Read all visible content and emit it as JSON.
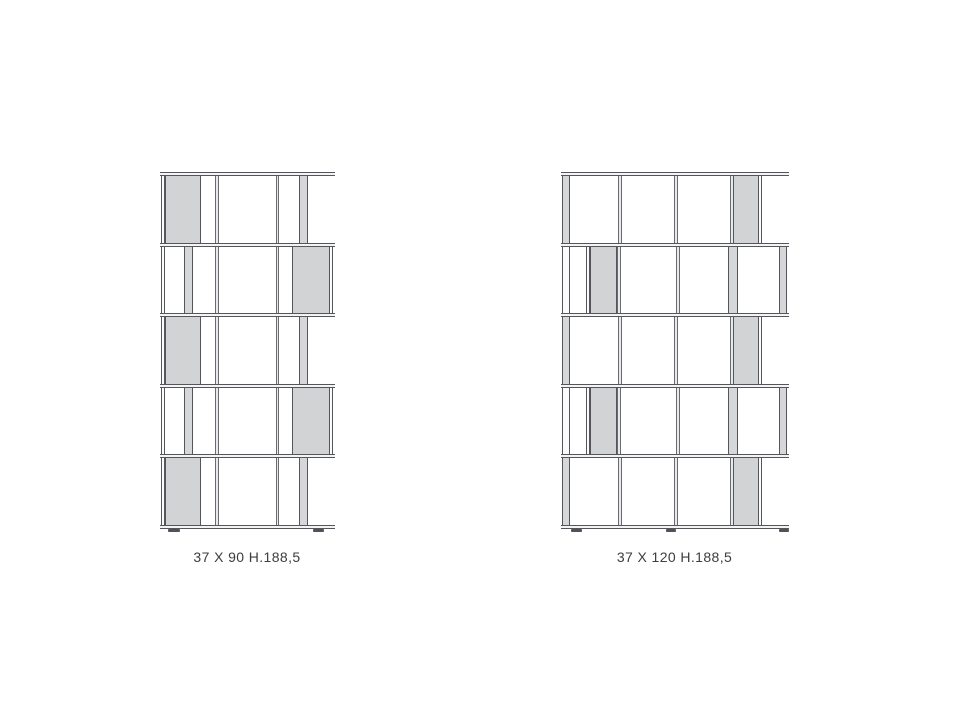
{
  "page": {
    "background": "#ffffff",
    "width": 970,
    "height": 728
  },
  "diagram": {
    "type": "furniture-dimension-drawing",
    "description": "Two staggered modular bookcase elevation drawings with size captions",
    "colors": {
      "line": "#55565b",
      "line_soft": "#6a6b70",
      "shelf_fill": "#f4f4f5",
      "panel_fill": "#d2d3d5",
      "post_fill": "#d6d7d9",
      "divider_fill": "#e8e9ea",
      "edge_fill": "#fbfbfc",
      "foot_color": "#515257",
      "label_color": "#3c3d41"
    },
    "units": [
      {
        "id": "bookcase-37x90",
        "label": "37 X 90 H.188,5",
        "origin": {
          "x": 161,
          "y": 172
        },
        "union_width": 172,
        "shelf_ys": [
          0,
          71,
          141,
          212,
          282,
          353
        ],
        "shelf_thickness": 3,
        "rows": [
          {
            "align": "left",
            "verticals": [
              {
                "x": 0,
                "w": 4,
                "t": "edge"
              },
              {
                "x": 54,
                "w": 4,
                "t": "divider"
              },
              {
                "x": 115,
                "w": 3,
                "t": "divider"
              },
              {
                "x": 138,
                "w": 9,
                "t": "post"
              }
            ],
            "panel": {
              "x": 4,
              "w": 36
            }
          },
          {
            "align": "right",
            "verticals": [
              {
                "x": 0,
                "w": 4,
                "t": "edge"
              },
              {
                "x": 23,
                "w": 9,
                "t": "post"
              },
              {
                "x": 54,
                "w": 4,
                "t": "divider"
              },
              {
                "x": 115,
                "w": 3,
                "t": "divider"
              },
              {
                "x": 168,
                "w": 4,
                "t": "edge"
              }
            ],
            "panel": {
              "x": 131,
              "w": 38
            }
          },
          {
            "align": "left",
            "verticals": [
              {
                "x": 0,
                "w": 4,
                "t": "edge"
              },
              {
                "x": 54,
                "w": 4,
                "t": "divider"
              },
              {
                "x": 115,
                "w": 3,
                "t": "divider"
              },
              {
                "x": 138,
                "w": 9,
                "t": "post"
              }
            ],
            "panel": {
              "x": 4,
              "w": 36
            }
          },
          {
            "align": "right",
            "verticals": [
              {
                "x": 0,
                "w": 4,
                "t": "edge"
              },
              {
                "x": 23,
                "w": 9,
                "t": "post"
              },
              {
                "x": 54,
                "w": 4,
                "t": "divider"
              },
              {
                "x": 115,
                "w": 3,
                "t": "divider"
              },
              {
                "x": 168,
                "w": 4,
                "t": "edge"
              }
            ],
            "panel": {
              "x": 131,
              "w": 38
            }
          },
          {
            "align": "left",
            "verticals": [
              {
                "x": 0,
                "w": 4,
                "t": "edge"
              },
              {
                "x": 54,
                "w": 4,
                "t": "divider"
              },
              {
                "x": 115,
                "w": 3,
                "t": "divider"
              },
              {
                "x": 138,
                "w": 9,
                "t": "post"
              }
            ],
            "panel": {
              "x": 4,
              "w": 36
            }
          }
        ],
        "feet": [
          {
            "x": 7,
            "w": 12
          },
          {
            "x": 152,
            "w": 11
          }
        ],
        "label_top": 377
      },
      {
        "id": "bookcase-37x120",
        "label": "37 X 120 H.188,5",
        "origin": {
          "x": 562,
          "y": 172
        },
        "union_width": 225,
        "shelf_ys": [
          0,
          71,
          141,
          212,
          282,
          353
        ],
        "shelf_thickness": 3,
        "rows": [
          {
            "align": "left",
            "verticals": [
              {
                "x": 0,
                "w": 8,
                "t": "post"
              },
              {
                "x": 56,
                "w": 4,
                "t": "divider"
              },
              {
                "x": 112,
                "w": 4,
                "t": "divider"
              },
              {
                "x": 168,
                "w": 4,
                "t": "divider"
              },
              {
                "x": 196,
                "w": 4,
                "t": "edge"
              }
            ],
            "panel": {
              "x": 171,
              "w": 26
            }
          },
          {
            "align": "right",
            "verticals": [
              {
                "x": 0,
                "w": 8,
                "t": "edge"
              },
              {
                "x": 24,
                "w": 4,
                "t": "edge"
              },
              {
                "x": 55,
                "w": 4,
                "t": "divider"
              },
              {
                "x": 114,
                "w": 4,
                "t": "divider"
              },
              {
                "x": 166,
                "w": 10,
                "t": "post"
              },
              {
                "x": 217,
                "w": 8,
                "t": "post"
              }
            ],
            "panel": {
              "x": 28,
              "w": 27
            }
          },
          {
            "align": "left",
            "verticals": [
              {
                "x": 0,
                "w": 8,
                "t": "post"
              },
              {
                "x": 56,
                "w": 4,
                "t": "divider"
              },
              {
                "x": 112,
                "w": 4,
                "t": "divider"
              },
              {
                "x": 168,
                "w": 4,
                "t": "divider"
              },
              {
                "x": 196,
                "w": 4,
                "t": "edge"
              }
            ],
            "panel": {
              "x": 171,
              "w": 26
            }
          },
          {
            "align": "right",
            "verticals": [
              {
                "x": 0,
                "w": 8,
                "t": "edge"
              },
              {
                "x": 24,
                "w": 4,
                "t": "edge"
              },
              {
                "x": 55,
                "w": 4,
                "t": "divider"
              },
              {
                "x": 114,
                "w": 4,
                "t": "divider"
              },
              {
                "x": 166,
                "w": 10,
                "t": "post"
              },
              {
                "x": 217,
                "w": 8,
                "t": "post"
              }
            ],
            "panel": {
              "x": 28,
              "w": 27
            }
          },
          {
            "align": "left",
            "verticals": [
              {
                "x": 0,
                "w": 8,
                "t": "post"
              },
              {
                "x": 56,
                "w": 4,
                "t": "divider"
              },
              {
                "x": 112,
                "w": 4,
                "t": "divider"
              },
              {
                "x": 168,
                "w": 4,
                "t": "divider"
              },
              {
                "x": 196,
                "w": 4,
                "t": "edge"
              }
            ],
            "panel": {
              "x": 171,
              "w": 26
            }
          }
        ],
        "feet": [
          {
            "x": 9,
            "w": 11
          },
          {
            "x": 104,
            "w": 10
          },
          {
            "x": 217,
            "w": 10
          }
        ],
        "label_top": 377
      }
    ]
  }
}
